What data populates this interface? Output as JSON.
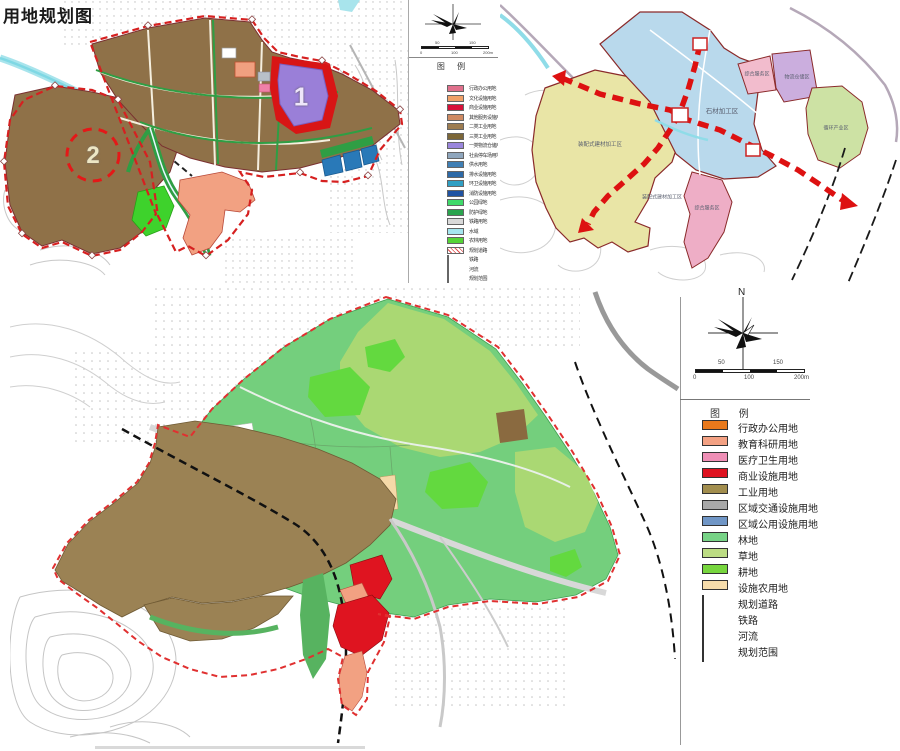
{
  "title": "用地规划图",
  "panelA": {
    "markers": {
      "m1": "1",
      "m2": "2"
    },
    "legend": {
      "header": "图 例",
      "scale": {
        "top": [
          "50",
          "150"
        ],
        "bottom": [
          "0",
          "100",
          "200m"
        ]
      },
      "items": [
        {
          "label": "行政办公用地",
          "color": "#e0708c"
        },
        {
          "label": "文化设施用地",
          "color": "#f0a068"
        },
        {
          "label": "商业设施用地",
          "color": "#d81038"
        },
        {
          "label": "其他服务设施用地",
          "color": "#cf8a62"
        },
        {
          "label": "二类工业用地",
          "color": "#9d7c50"
        },
        {
          "label": "三类工业用地",
          "color": "#7c6738"
        },
        {
          "label": "一类物流仓储用地",
          "color": "#9a86dc"
        },
        {
          "label": "社会停车场用地",
          "color": "#8fa6bd"
        },
        {
          "label": "供水用地",
          "color": "#3f7fb5"
        },
        {
          "label": "排水设施用地",
          "color": "#2d6aa8"
        },
        {
          "label": "环卫设施用地",
          "color": "#2f9fc4"
        },
        {
          "label": "消防设施用地",
          "color": "#1f53a2"
        },
        {
          "label": "公园绿地",
          "color": "#3fd96a"
        },
        {
          "label": "防护绿地",
          "color": "#2aa44e"
        },
        {
          "label": "铁路用地",
          "color": "#d9d9d9"
        },
        {
          "label": "水域",
          "color": "#a5e6ef"
        },
        {
          "label": "农林用地",
          "color": "#55d437"
        },
        {
          "label": "规划道路",
          "type": "road"
        },
        {
          "label": "铁路",
          "type": "rail"
        },
        {
          "label": "河流",
          "type": "river"
        },
        {
          "label": "规划范围",
          "type": "boundary"
        }
      ]
    }
  },
  "panelB": {
    "labels": {
      "stone": "石材加工区",
      "service_top": "综合服务区",
      "logistics": "物流仓储区",
      "circular": "循环产业区",
      "prefab1": "装配式建材加工区",
      "prefab2": "装配式建材加工区",
      "service_bottom": "综合服务区"
    }
  },
  "panelC": {
    "compass_n": "N",
    "legend": {
      "header": "图 例",
      "scale": {
        "top": [
          "50",
          "150"
        ],
        "bottom": [
          "0",
          "100",
          "200m"
        ]
      },
      "items": [
        {
          "label": "行政办公用地",
          "color": "#e8791c"
        },
        {
          "label": "教育科研用地",
          "color": "#f3a183"
        },
        {
          "label": "医疗卫生用地",
          "color": "#ef8fb6"
        },
        {
          "label": "商业设施用地",
          "color": "#de1220"
        },
        {
          "label": "工业用地",
          "color": "#a28e4e"
        },
        {
          "label": "区域交通设施用地",
          "color": "#a8a8a8"
        },
        {
          "label": "区域公用设施用地",
          "color": "#7096c6"
        },
        {
          "label": "林地",
          "color": "#77d386"
        },
        {
          "label": "草地",
          "color": "#bcdc83"
        },
        {
          "label": "耕地",
          "color": "#77d63e"
        },
        {
          "label": "设施农用地",
          "color": "#f6dcab"
        },
        {
          "label": "规划道路",
          "type": "road"
        },
        {
          "label": "铁路",
          "type": "rail"
        },
        {
          "label": "河流",
          "type": "river"
        },
        {
          "label": "规划范围",
          "type": "boundary"
        }
      ]
    }
  }
}
